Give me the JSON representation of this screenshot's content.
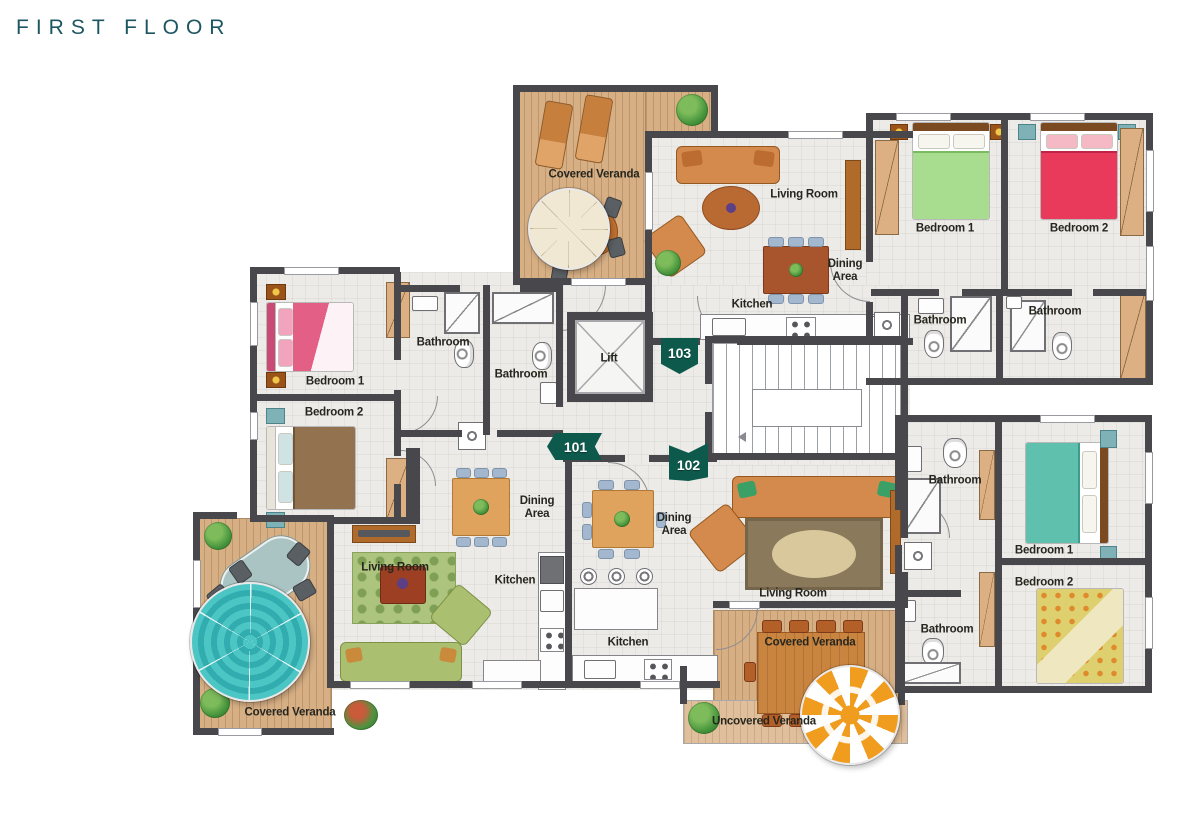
{
  "title": "FIRST FLOOR",
  "units": {
    "u101": "101",
    "u102": "102",
    "u103": "103"
  },
  "rooms": {
    "covered_veranda": "Covered Veranda",
    "uncovered_veranda": "Uncovered Veranda",
    "living_room": "Living Room",
    "dining_area": "Dining Area",
    "kitchen": "Kitchen",
    "bathroom": "Bathroom",
    "bedroom_1": "Bedroom 1",
    "bedroom_2": "Bedroom 2",
    "lift": "Lift"
  },
  "colors": {
    "title_text": "#1d5661",
    "unit_badge": "#0d5a4d",
    "wall": "#47474c",
    "floor_tile": "#edebe7",
    "deck_wood": "#d6af85",
    "deck_wood_uncovered": "#e0c09c",
    "sofa_orange": "#d4894d",
    "sofa_green": "#aabf70",
    "bed_green": "#a8dc8e",
    "bed_red": "#ea3a5c",
    "bed_pink": "#e45f86",
    "bed_brown": "#93724f",
    "bed_teal": "#5fc0ae",
    "bed_floral": "#ded06f",
    "umbrella_teal": "#46c0c0",
    "umbrella_orange": "#f09c1e",
    "umbrella_cream": "#f0e8d2",
    "dining_table_wood": "#dfa35e",
    "chair_blue": "#a3b8cf",
    "rug_green": "#adc47e",
    "rug_brown": "#8a795b"
  }
}
